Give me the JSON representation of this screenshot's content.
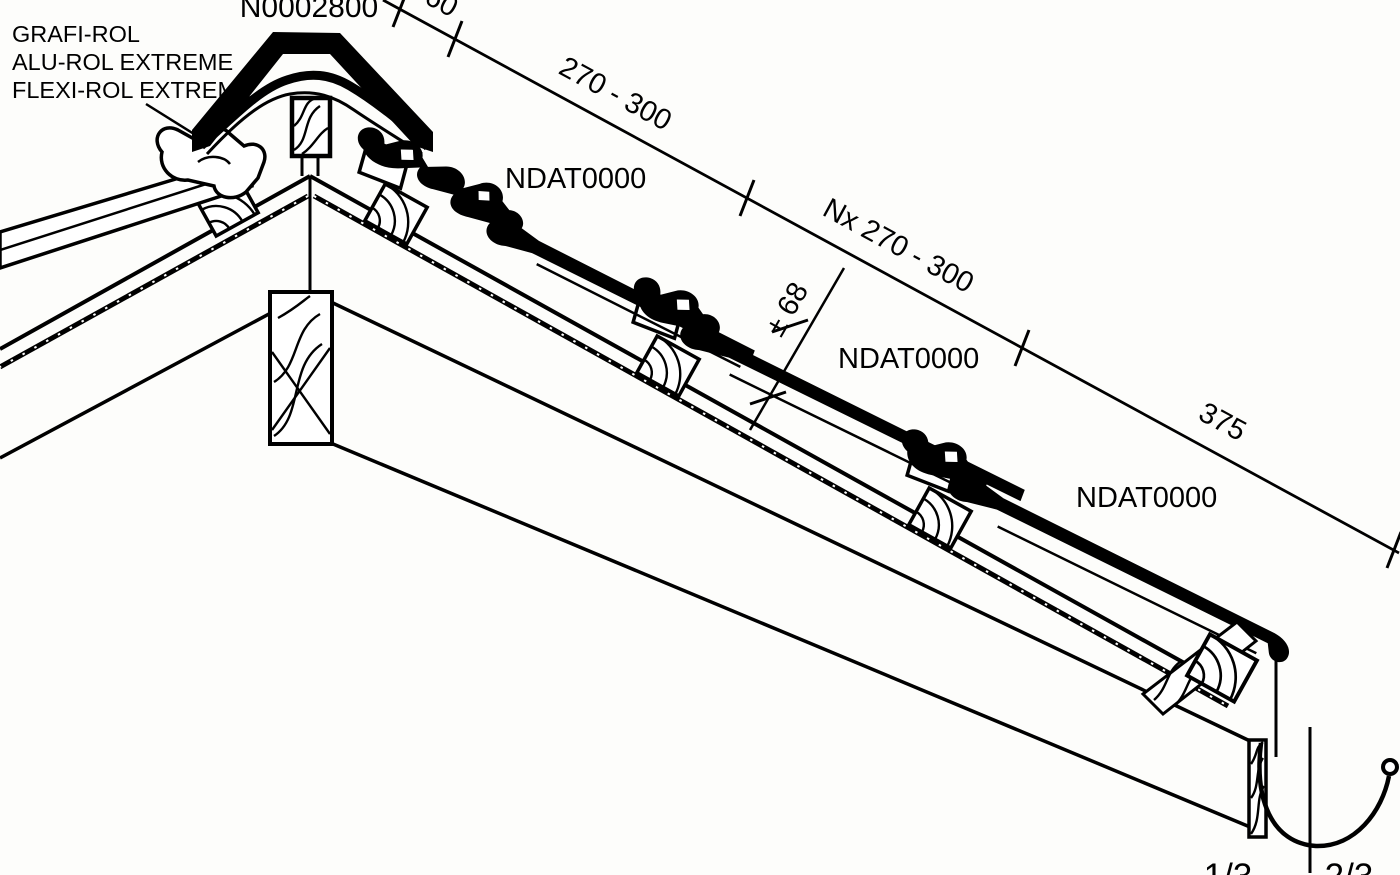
{
  "title": "Roof ridge-to-eave cross-section technical drawing",
  "colors": {
    "background": "#fdfdfb",
    "line": "#000000"
  },
  "labels": {
    "ridge_cap_code": "N0002800",
    "ridge_roll_products": [
      "GRAFI-ROL",
      "ALU-ROL EXTREME",
      "FLEXI-ROL EXTREME"
    ],
    "tile_code_top": "NDAT0000",
    "tile_code_middle": "NDAT0000",
    "tile_code_bottom": "NDAT0000",
    "eave_overhang_left": "1/3",
    "eave_overhang_right": "2/3"
  },
  "dimensions": {
    "ridge_to_first_batten": "60",
    "top_course_spacing": "270 - 300",
    "field_course_spacing": "Nx 270 - 300",
    "head_lap_tolerance": "± 68",
    "eave_course_spacing": "375"
  }
}
